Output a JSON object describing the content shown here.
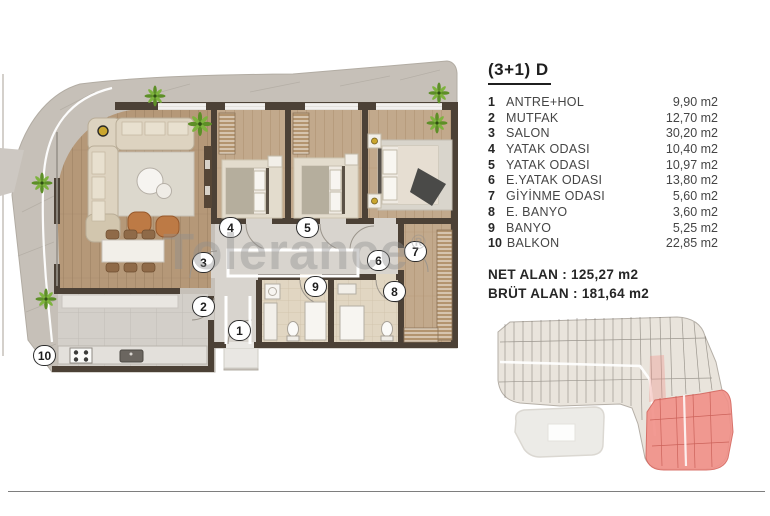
{
  "plan": {
    "title": "(3+1) D",
    "rooms": [
      {
        "num": "1",
        "name": "ANTRE+HOL",
        "area": "9,90 m2"
      },
      {
        "num": "2",
        "name": "MUTFAK",
        "area": "12,70 m2"
      },
      {
        "num": "3",
        "name": "SALON",
        "area": "30,20 m2"
      },
      {
        "num": "4",
        "name": "YATAK ODASI",
        "area": "10,40 m2"
      },
      {
        "num": "5",
        "name": "YATAK ODASI",
        "area": "10,97 m2"
      },
      {
        "num": "6",
        "name": "E.YATAK ODASI",
        "area": "13,80 m2"
      },
      {
        "num": "7",
        "name": "GİYİNME ODASI",
        "area": "5,60 m2"
      },
      {
        "num": "8",
        "name": "E. BANYO",
        "area": "3,60 m2"
      },
      {
        "num": "9",
        "name": "BANYO",
        "area": "5,25 m2"
      },
      {
        "num": "10",
        "name": "BALKON",
        "area": "22,85 m2"
      }
    ],
    "totals": {
      "net": "NET ALAN : 125,27 m2",
      "brut": "BRÜT ALAN : 181,64 m2"
    }
  },
  "watermark": {
    "text": "Tolerance",
    "reg": "®"
  },
  "colors": {
    "wall": "#4c4136",
    "wood_floor": "#b59878",
    "wood_floor_light": "#c2a98c",
    "balcony_stone": "#c6c0b8",
    "hall_floor": "#d8d4ce",
    "kitchen_tile": "#d3cfc9",
    "bath_tile": "#e1d6c2",
    "plant_green": "#6fa22e",
    "site_building": "#e9e4dc",
    "site_highlight": "#f19088",
    "site_highlight_line": "#c9554c"
  }
}
